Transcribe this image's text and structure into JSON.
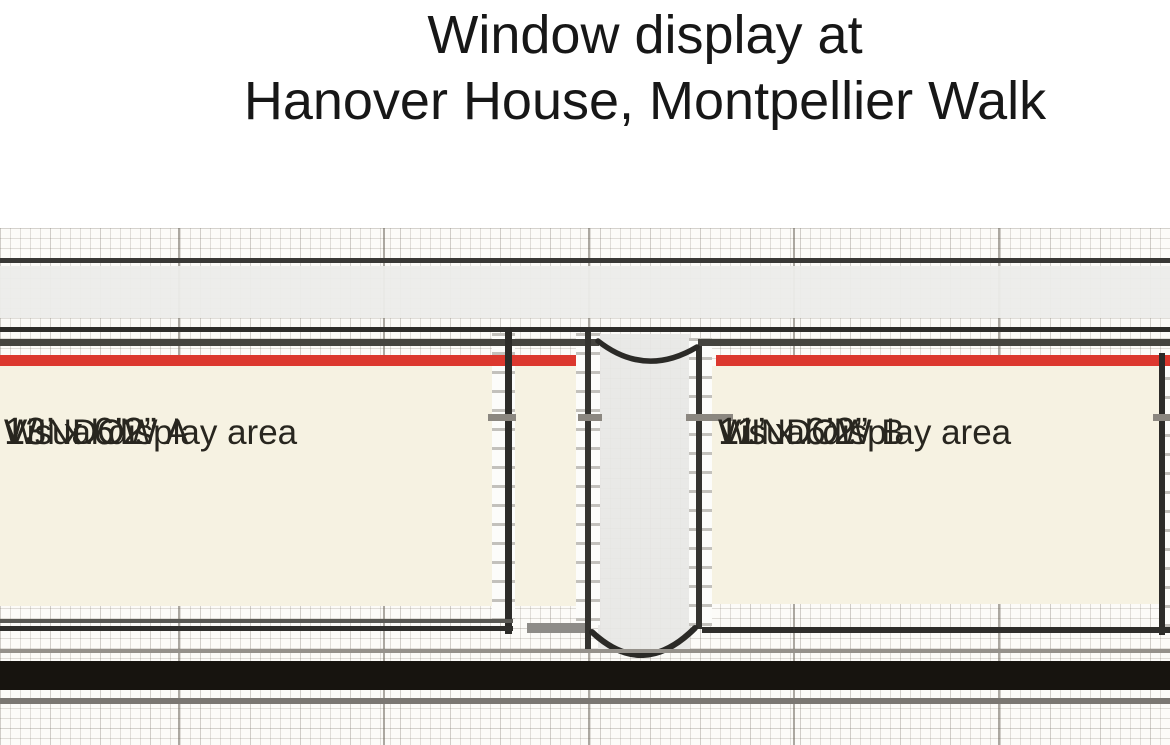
{
  "title": {
    "line1": "Window display at",
    "line2": "Hanover House, Montpellier Walk"
  },
  "plan": {
    "windows": [
      {
        "name": "WINDOW A",
        "subtitle": "Visual display area",
        "dimensions": "13’ x 6’2”"
      },
      {
        "name": "WINDOW B",
        "subtitle": "Visual display area",
        "dimensions": "11’ x 6’2”"
      }
    ]
  },
  "colors": {
    "highlight_red": "#dc382e",
    "display_area_cream": "#f6f2e2",
    "pavement_black": "#17140f",
    "walkway_band_gray": "#ececea",
    "structure_line_dark": "#2f2e2b",
    "grid_line": "#d9d5cf"
  }
}
